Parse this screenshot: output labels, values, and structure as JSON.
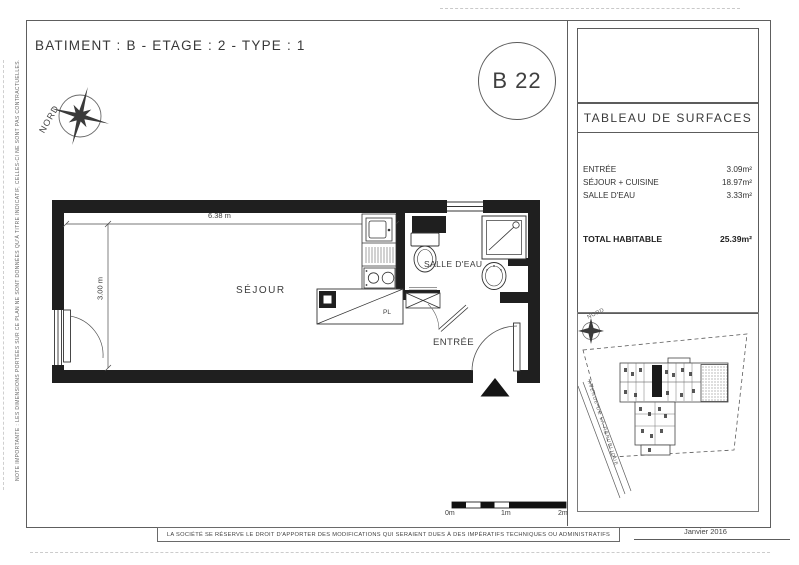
{
  "meta": {
    "title": "BATIMENT : B - ETAGE : 2 - TYPE : 1",
    "unit_code": "B 22",
    "date": "Janvier 2016"
  },
  "side_note": "NOTE IMPORTANTE : LES DIMENSIONS PORTÉES SUR CE PLAN NE SONT DONNÉES QU'À TITRE INDICATIF, CELLES-CI NE SONT PAS CONTRACTUELLES.",
  "compass": {
    "label": "NORD"
  },
  "plan": {
    "rooms": {
      "sejour": "SÉJOUR",
      "salle_deau": "SALLE D'EAU",
      "entree": "ENTRÉE",
      "placard": "PL"
    },
    "dimensions": {
      "width": "6.38 m",
      "depth": "3.00 m"
    }
  },
  "surface_table": {
    "title": "TABLEAU DE SURFACES",
    "rows": [
      {
        "label": "ENTRÉE",
        "value": "3.09m²"
      },
      {
        "label": "SÉJOUR + CUISINE",
        "value": "18.97m²"
      },
      {
        "label": "SALLE D'EAU",
        "value": "3.33m²"
      }
    ],
    "total": {
      "label": "TOTAL HABITABLE",
      "value": "25.39m²"
    }
  },
  "site_plan": {
    "compass_label": "NORD",
    "street": "AVENUE DE LA RÉPUBLIQUE"
  },
  "scale_bar": {
    "ticks": [
      "0m",
      "1m",
      "2m"
    ]
  },
  "footer": {
    "disclaimer": "LA SOCIÉTÉ SE RÉSERVE LE DROIT D'APPORTER DES MODIFICATIONS QUI SERAIENT DUES À DES IMPÉRATIFS TECHNIQUES OU ADMINISTRATIFS"
  }
}
